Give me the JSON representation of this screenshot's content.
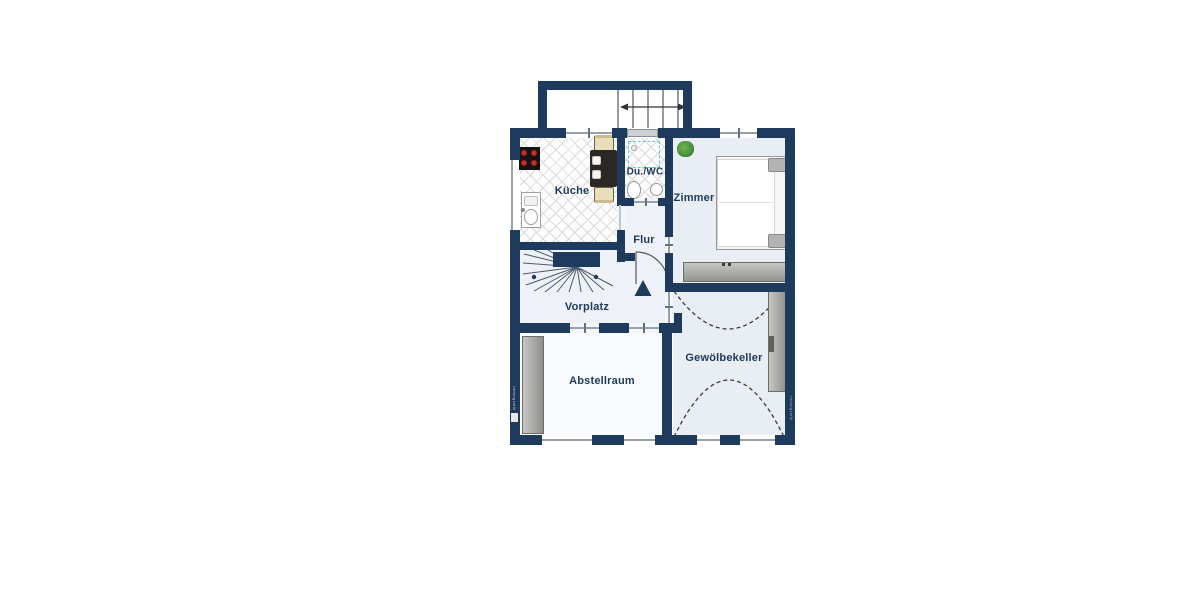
{
  "plan": {
    "type": "floor-plan",
    "language": "de"
  },
  "rooms": [
    {
      "label": "Küche"
    },
    {
      "label": "Du./WC"
    },
    {
      "label": "Zimmer"
    },
    {
      "label": "Flur"
    },
    {
      "label": "Vorplatz"
    },
    {
      "label": "Abstellraum"
    },
    {
      "label": "Gewölbekeller"
    }
  ],
  "watermarks": {
    "left": "Immografik",
    "right": "Immografik"
  },
  "colors": {
    "wall": "#1e3a5c",
    "floor_blue": "#e9edf4",
    "floor_pale": "#f8fafc",
    "tile_line": "#dadada",
    "furniture_gray": "#a9a9a7",
    "stove_black": "#141414",
    "burner_red": "#b5261e",
    "plant_green": "#4c9440",
    "shower_teal": "#5fc9d2",
    "chair_cream": "#e8dfb8",
    "table_dark": "#2d2723"
  }
}
